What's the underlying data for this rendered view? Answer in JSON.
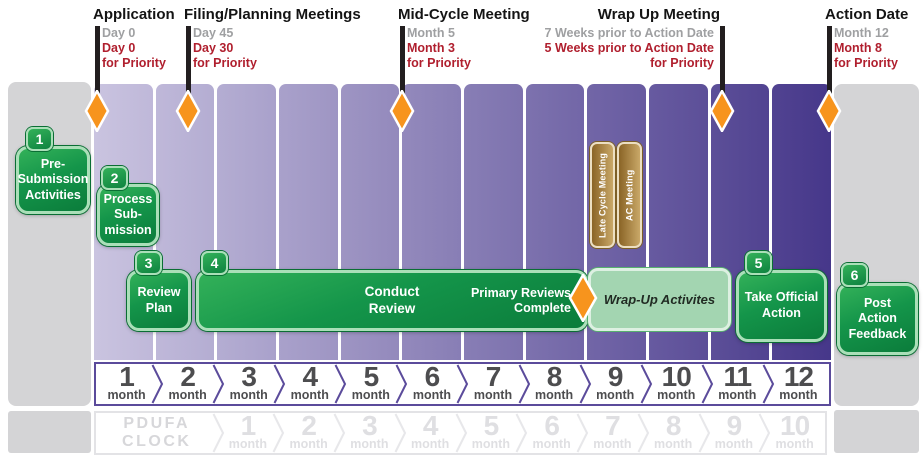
{
  "header": {
    "milestones": [
      {
        "title": "Application",
        "standard": "Day 0",
        "priority": "Day 0",
        "priority_suffix": "for Priority"
      },
      {
        "title": "Filing/Planning Meetings",
        "standard": "Day 45",
        "priority": "Day 30",
        "priority_suffix": "for Priority"
      },
      {
        "title": "Mid-Cycle Meeting",
        "standard": "Month 5",
        "priority": "Month 3",
        "priority_suffix": "for Priority"
      },
      {
        "title": "Wrap Up Meeting",
        "standard": "7 Weeks prior to Action Date",
        "priority": "5 Weeks prior to Action Date",
        "priority_suffix": "for Priority"
      },
      {
        "title": "Action Date",
        "standard": "Month 12",
        "priority": "Month 8",
        "priority_suffix": "for Priority"
      }
    ]
  },
  "steps": [
    {
      "num": "1",
      "label": "Pre-\nSubmission\nActivities"
    },
    {
      "num": "2",
      "label": "Process\nSub-\nmission"
    },
    {
      "num": "3",
      "label": "Review\nPlan"
    },
    {
      "num": "4",
      "label": "Conduct\nReview"
    },
    {
      "num": "5",
      "label": "Take Official\nAction"
    },
    {
      "num": "6",
      "label": "Post\nAction\nFeedback"
    }
  ],
  "review_bar": {
    "complete_label": "Primary Reviews\nComplete",
    "wrap_up_label": "Wrap-Up Activites"
  },
  "meetings": [
    {
      "label": "Late Cycle Meeting"
    },
    {
      "label": "AC Meeting"
    }
  ],
  "timeline": {
    "unit": "month",
    "months": [
      "1",
      "2",
      "3",
      "4",
      "5",
      "6",
      "7",
      "8",
      "9",
      "10",
      "11",
      "12"
    ]
  },
  "pdufa": {
    "line1": "PDUFA",
    "line2": "CLOCK",
    "unit": "month",
    "months": [
      "1",
      "2",
      "3",
      "4",
      "5",
      "6",
      "7",
      "8",
      "9",
      "10"
    ]
  },
  "colors": {
    "green": "#14954a",
    "green_border": "#aadfb8",
    "wrapup_bg": "#a3d5b1",
    "orange": "#f7941d",
    "red": "#b01f2e",
    "gray_label": "#9fa0a2",
    "purple_border": "#5b4b9b",
    "pdufa_border": "#e7e7ea",
    "column_light": "#cac4e0",
    "column_dark": "#46378a",
    "tan_light": "#c9a868",
    "tan_dark": "#8a6426",
    "panel_gray": "#d4d4d6"
  }
}
